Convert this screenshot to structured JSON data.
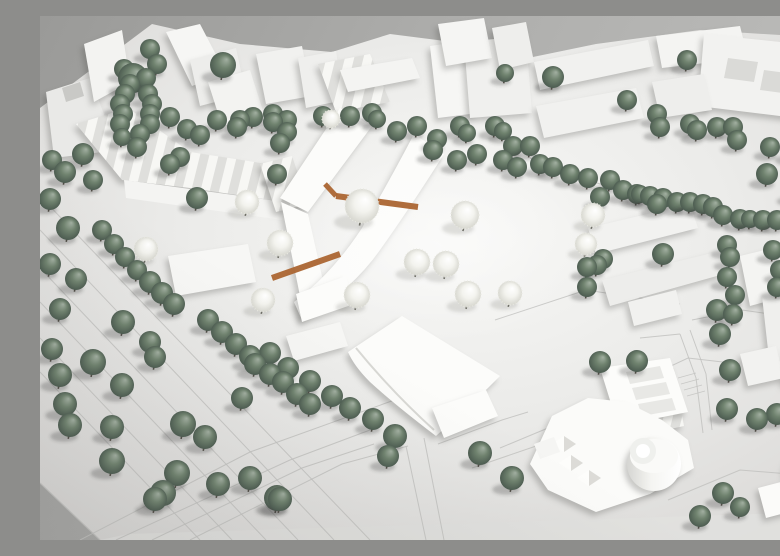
{
  "scene": {
    "description": "Photograph of a white architectural site model: massing buildings, sage-green spherical trees, white blossom trees, engraved street lines, terracotta wooden deck paths, on a gray backdrop"
  },
  "palette": {
    "backdrop_dark": "#9a9a98",
    "backdrop_light": "#bcbcba",
    "base_bright": "#f8f8f6",
    "base_mid": "#ebebe9",
    "base_dim": "#d6d5d3",
    "base_front": "#e1e1df",
    "road_line": "#c2c2bf",
    "building_top": "#f4f4f2",
    "building_new": "#fcfcfa",
    "courtyard": "#dadad7",
    "gable_light": "#f7f7f4",
    "gable_dark": "#dfdfdc",
    "tree_green_hi": "#a3b0a2",
    "tree_green_mid": "#70836f",
    "tree_green_lo": "#47564c",
    "tree_trunk": "#4e4b44",
    "blossom_hi": "#ffffff",
    "blossom_lo": "#d3d3cb",
    "terracotta": "#ab6531",
    "shadow": "rgba(55,60,55,0.28)"
  },
  "base": {
    "outline": "0,92 112,8 200,28 292,36 350,18 476,34 488,42 556,28 660,14 756,20 780,26 780,524 60,524 0,467",
    "front_edge": "60,524 88,518 780,496 780,524",
    "plaza_highlight": [
      390,
      232,
      165,
      100
    ]
  },
  "roads": [
    {
      "p": "0,286 226,524"
    },
    {
      "p": "0,252 258,524"
    },
    {
      "p": "0,214 294,524"
    },
    {
      "p": "0,180 330,524"
    },
    {
      "p": "0,322 192,524"
    },
    {
      "p": "0,356 160,524"
    },
    {
      "p": "40,524 210,436 360,382"
    },
    {
      "p": "76,524 250,444 330,414"
    },
    {
      "p": "112,524 262,452 334,428"
    },
    {
      "p": "150,524 302,448 368,430"
    },
    {
      "p": "398,428 462,404 488,396"
    },
    {
      "p": "432,452 502,428"
    },
    {
      "p": "366,430 386,524"
    },
    {
      "p": "384,422 404,524"
    },
    {
      "p": "640,318 656,362 663,417"
    },
    {
      "p": "650,314 666,358 672,414"
    },
    {
      "p": "600,322 640,318"
    },
    {
      "p": "455,304 546,274 640,288"
    },
    {
      "p": "584,372 648,342 700,348"
    },
    {
      "p": "652,304 702,294 758,302"
    },
    {
      "p": "628,484 700,454 762,459"
    },
    {
      "p": "460,432 532,402"
    },
    {
      "p": "490,142 560,168 670,192"
    },
    {
      "p": "638,362 656,357",
      "w": 0.8
    },
    {
      "p": "641,368 659,363",
      "w": 0.8
    },
    {
      "p": "644,374 662,369",
      "w": 0.8
    },
    {
      "p": "647,380 665,375",
      "w": 0.8
    },
    {
      "p": "0,467 60,524",
      "w": 1.3
    }
  ],
  "buildings": [
    {
      "n": "house-nw",
      "poly": "6,76 50,62 64,98 62,136 14,142",
      "f": "#e9e9e7"
    },
    {
      "n": "house-nw-notch",
      "poly": "22,72 40,66 44,80 26,86",
      "f": "#c9c9c6",
      "flat": 1
    },
    {
      "n": "tower-nw",
      "poly": "44,28 82,14 90,66 54,86",
      "f": "#f3f3f1"
    },
    {
      "n": "slab-n1",
      "poly": "126,16 160,8 186,58 152,70",
      "f": "#f6f6f4"
    },
    {
      "n": "slab-n2",
      "poly": "150,44 196,32 206,78 160,90",
      "f": "#ededeb"
    },
    {
      "n": "sawtooth-row",
      "path": "M36,108 L88,92 L150,136 L240,150 L244,186 L150,172 L82,164 Z",
      "f": "gables"
    },
    {
      "n": "sawtooth-face",
      "poly": "84,164 244,186 242,204 86,182",
      "f": "#f4f4f2",
      "flat": 1
    },
    {
      "n": "gable-house-n",
      "poly": "220,148 252,140 268,188 236,196",
      "f": "gables"
    },
    {
      "n": "slab-n3",
      "poly": "168,66 210,54 224,98 182,110",
      "f": "#f3f3f1"
    },
    {
      "n": "block-n1",
      "poly": "216,38 262,30 272,80 226,88",
      "f": "#f1f1ef"
    },
    {
      "n": "block-n2",
      "poly": "258,42 296,35 304,84 266,92",
      "f": "#efefed"
    },
    {
      "n": "houses-nc",
      "poly": "278,48 330,38 350,86 296,96",
      "f": "gables"
    },
    {
      "n": "bar-nc",
      "poly": "300,54 372,42 380,62 308,76",
      "f": "#f4f4f2"
    },
    {
      "n": "gable-block-nc",
      "poly": "390,30 430,24 438,97 398,102",
      "f": "#f6f6f4"
    },
    {
      "n": "block-nc",
      "poly": "424,26 486,20 492,97 430,102",
      "f": "#f0f0ee"
    },
    {
      "n": "tower-nc1",
      "poly": "398,8 444,2 452,42 406,50",
      "f": "#f5f5f3"
    },
    {
      "n": "tower-nc2",
      "poly": "452,12 486,6 494,46 460,54",
      "f": "#eeeeec"
    },
    {
      "n": "bar-ne",
      "poly": "494,46 608,24 614,50 500,74",
      "f": "#f1f1ef"
    },
    {
      "n": "bar-ne2",
      "poly": "616,20 700,10 708,42 622,52",
      "f": "#f4f4f2"
    },
    {
      "n": "perimeter-block-ne",
      "poly": "664,18 778,30 772,104 658,90",
      "f": "#f2f2f0"
    },
    {
      "n": "courtyard-1",
      "poly": "688,42 718,46 714,66 684,62",
      "f": "#dadad7",
      "flat": 1
    },
    {
      "n": "courtyard-2",
      "poly": "724,54 754,58 750,78 720,74",
      "f": "#dadad7",
      "flat": 1
    },
    {
      "n": "slab-ne3",
      "poly": "496,90 596,72 604,102 504,122",
      "f": "#f1f1ef"
    },
    {
      "n": "block-ne4",
      "poly": "612,66 664,58 672,94 620,102",
      "f": "#eeeeec"
    },
    {
      "n": "slab-e1",
      "poly": "756,122 780,116 780,162 762,167",
      "f": "#f0f0ee"
    },
    {
      "n": "slab-e2",
      "poly": "548,212 650,188 658,212 556,238",
      "f": "#f2f2f0"
    },
    {
      "n": "slab-e3",
      "poly": "562,264 676,236 684,258 570,290",
      "f": "#ededeb"
    },
    {
      "n": "block-e1",
      "poly": "700,240 766,224 776,272 710,290",
      "f": "#f4f4f2"
    },
    {
      "n": "tower-e",
      "poly": "722,280 770,270 778,340 730,352",
      "f": "#efefed"
    },
    {
      "n": "cube-e",
      "poly": "740,344 762,339 766,364 744,369",
      "f": "#f3f3f1"
    },
    {
      "n": "slab-e4",
      "poly": "588,286 636,274 642,298 594,310",
      "f": "#f1f1ef"
    },
    {
      "n": "houses-se",
      "poly": "588,362 634,352 644,410 598,420",
      "f": "gables"
    },
    {
      "n": "kita-block",
      "poly": "128,240 208,228 216,266 136,280",
      "f": "#f7f7f5"
    },
    {
      "n": "chevron-north-wing",
      "poly": "240,182 300,92 332,110 268,196",
      "f": "#fcfcfa"
    },
    {
      "n": "chevron-south-wing",
      "poly": "241,186 268,198 286,278 262,290",
      "f": "#fcfcfa"
    },
    {
      "n": "curved-bar",
      "path": "M374,118 L404,138 Q370,192 340,234 Q312,274 262,304 L254,286 Q292,258 322,212 Q350,164 374,118 Z",
      "f": "#fcfcfa"
    },
    {
      "n": "bar-end-block",
      "poly": "256,278 306,260 314,288 262,306",
      "f": "#fcfcfa"
    },
    {
      "n": "hall-west-bar",
      "poly": "246,320 300,306 308,330 254,345",
      "f": "#f6f6f4"
    },
    {
      "n": "hall",
      "path": "M308,336 L362,300 L460,360 L448,372 L396,420 Q354,388 330,366 Q314,350 308,336 Z",
      "f": "#fcfcfa"
    },
    {
      "n": "hall-facade-curve",
      "path": "M316,332 Q352,376 394,414",
      "f": "none",
      "s": "#d8d8d4",
      "w": 2,
      "flat": 1
    },
    {
      "n": "hall-annex",
      "poly": "392,392 446,374 458,400 404,422",
      "f": "#fcfcfa"
    },
    {
      "n": "cluster-slab",
      "poly": "560,352 630,342 648,396 578,410",
      "f": "#fcfcfa"
    },
    {
      "n": "roof-bar-1",
      "poly": "586,356 620,350 624,362 590,368",
      "f": "#e8e8e5",
      "flat": 1
    },
    {
      "n": "roof-bar-2",
      "poly": "592,372 626,366 630,378 596,384",
      "f": "#e8e8e5",
      "flat": 1
    },
    {
      "n": "roof-bar-3",
      "poly": "598,388 632,382 636,394 602,400",
      "f": "#e8e8e5",
      "flat": 1
    },
    {
      "n": "cluster-main",
      "poly": "490,448 512,400 548,382 586,386 622,404 648,424 654,452 610,478 556,496 508,474",
      "f": "#fbfbf9"
    },
    {
      "n": "cylinder-big",
      "c": [
        614,
        448,
        27
      ],
      "f": "gCyl"
    },
    {
      "n": "cylinder-big-top",
      "e": [
        614,
        440,
        24,
        17
      ],
      "f": "#fafaf8",
      "flat": 1
    },
    {
      "n": "cylinder-ring",
      "c": [
        603,
        435,
        13
      ],
      "f": "#eff0ed",
      "flat": 1
    },
    {
      "n": "cylinder-ring-top",
      "c": [
        603,
        435,
        7
      ],
      "f": "#ffffff",
      "flat": 1
    },
    {
      "n": "pyramid-1-light",
      "poly": "519,447 531,439 531,455",
      "f": "#fdfdfb",
      "flat": 1
    },
    {
      "n": "pyramid-1-dark",
      "poly": "531,439 543,447 531,455",
      "f": "#dcdbd7",
      "flat": 1
    },
    {
      "n": "pyramid-2-light",
      "poly": "537,462 549,454 549,470",
      "f": "#fdfdfb",
      "flat": 1
    },
    {
      "n": "pyramid-2-dark",
      "poly": "549,454 561,462 549,470",
      "f": "#dcdbd7",
      "flat": 1
    },
    {
      "n": "pyramid-3-light",
      "poly": "512,428 524,420 524,436",
      "f": "#fdfdfb",
      "flat": 1
    },
    {
      "n": "pyramid-3-dark",
      "poly": "524,420 536,428 524,436",
      "f": "#dcdbd7",
      "flat": 1
    },
    {
      "n": "steps-block",
      "poly": "494,428 514,421 520,436 500,443",
      "f": "#f5f5f3",
      "flat": 1
    },
    {
      "n": "block-se1",
      "poly": "700,338 736,330 744,362 708,370",
      "f": "#f2f2f0"
    },
    {
      "n": "block-se2",
      "poly": "746,332 780,324 780,370 752,374",
      "f": "#efefed"
    },
    {
      "n": "block-se3",
      "poly": "752,382 780,376 780,428 758,432",
      "f": "#f1f1ef"
    },
    {
      "n": "tower-se-box",
      "poly": "718,472 756,462 764,492 726,502",
      "f": "#fbfbf9"
    },
    {
      "n": "tower-se-cylinder",
      "c": [
        764,
        454,
        19
      ],
      "f": "gCyl"
    },
    {
      "n": "tower-se-cylinder-top",
      "e": [
        763,
        447,
        16,
        11
      ],
      "f": "#f7f7f5",
      "flat": 1
    }
  ],
  "terracotta_paths": [
    {
      "p": "285,168 296,180",
      "w": 5
    },
    {
      "p": "296,180 378,191",
      "w": 6
    },
    {
      "p": "232,262 300,238",
      "w": 6
    }
  ],
  "trees_green": [
    [
      93,
      62,
      15
    ],
    [
      183,
      49,
      13
    ],
    [
      110,
      33,
      10
    ],
    [
      117,
      48,
      10
    ],
    [
      106,
      62,
      10
    ],
    [
      84,
      53,
      10
    ],
    [
      90,
      68,
      10
    ],
    [
      85,
      78,
      10
    ],
    [
      80,
      88,
      10
    ],
    [
      108,
      78,
      10
    ],
    [
      112,
      88,
      10
    ],
    [
      83,
      98,
      10
    ],
    [
      110,
      98,
      10
    ],
    [
      80,
      108,
      10
    ],
    [
      110,
      108,
      10
    ],
    [
      100,
      118,
      10
    ],
    [
      82,
      121,
      9
    ],
    [
      97,
      131,
      10
    ],
    [
      130,
      101,
      10
    ],
    [
      147,
      113,
      10
    ],
    [
      160,
      119,
      10
    ],
    [
      177,
      104,
      10
    ],
    [
      197,
      111,
      10
    ],
    [
      213,
      101,
      10
    ],
    [
      233,
      98,
      10
    ],
    [
      247,
      104,
      10
    ],
    [
      140,
      141,
      10
    ],
    [
      130,
      148,
      10
    ],
    [
      157,
      182,
      11
    ],
    [
      237,
      158,
      10
    ],
    [
      240,
      127,
      10
    ],
    [
      43,
      138,
      11
    ],
    [
      25,
      156,
      11
    ],
    [
      53,
      164,
      10
    ],
    [
      12,
      144,
      10
    ],
    [
      10,
      183,
      11
    ],
    [
      28,
      212,
      12
    ],
    [
      10,
      248,
      11
    ],
    [
      36,
      263,
      11
    ],
    [
      20,
      293,
      11
    ],
    [
      62,
      214,
      10
    ],
    [
      74,
      228,
      10
    ],
    [
      85,
      241,
      10
    ],
    [
      97,
      254,
      10
    ],
    [
      110,
      266,
      11
    ],
    [
      122,
      277,
      11
    ],
    [
      134,
      288,
      11
    ],
    [
      200,
      104,
      10
    ],
    [
      233,
      106,
      10
    ],
    [
      247,
      116,
      10
    ],
    [
      283,
      100,
      10
    ],
    [
      310,
      100,
      10
    ],
    [
      332,
      97,
      10
    ],
    [
      337,
      103,
      9
    ],
    [
      357,
      115,
      10
    ],
    [
      377,
      110,
      10
    ],
    [
      397,
      123,
      10
    ],
    [
      420,
      110,
      10
    ],
    [
      427,
      117,
      9
    ],
    [
      455,
      110,
      10
    ],
    [
      463,
      115,
      9
    ],
    [
      473,
      130,
      10
    ],
    [
      490,
      130,
      10
    ],
    [
      465,
      57,
      9
    ],
    [
      393,
      134,
      10
    ],
    [
      417,
      144,
      10
    ],
    [
      437,
      138,
      10
    ],
    [
      463,
      144,
      10
    ],
    [
      477,
      151,
      10
    ],
    [
      513,
      61,
      11
    ],
    [
      587,
      84,
      10
    ],
    [
      617,
      98,
      10
    ],
    [
      620,
      111,
      10
    ],
    [
      647,
      44,
      10
    ],
    [
      650,
      108,
      10
    ],
    [
      657,
      114,
      10
    ],
    [
      677,
      111,
      10
    ],
    [
      693,
      111,
      10
    ],
    [
      697,
      124,
      10
    ],
    [
      730,
      131,
      10
    ],
    [
      753,
      134,
      11
    ],
    [
      727,
      158,
      11
    ],
    [
      763,
      161,
      11
    ],
    [
      500,
      148,
      10
    ],
    [
      513,
      151,
      10
    ],
    [
      530,
      158,
      10
    ],
    [
      548,
      162,
      10
    ],
    [
      570,
      164,
      10
    ],
    [
      583,
      174,
      10
    ],
    [
      597,
      178,
      10
    ],
    [
      610,
      180,
      10
    ],
    [
      623,
      182,
      10
    ],
    [
      637,
      186,
      10
    ],
    [
      650,
      186,
      10
    ],
    [
      663,
      188,
      10
    ],
    [
      560,
      181,
      10
    ],
    [
      600,
      178,
      9
    ],
    [
      617,
      188,
      10
    ],
    [
      673,
      191,
      10
    ],
    [
      683,
      199,
      10
    ],
    [
      700,
      203,
      10
    ],
    [
      710,
      203,
      9
    ],
    [
      723,
      204,
      10
    ],
    [
      737,
      204,
      10
    ],
    [
      753,
      176,
      10
    ],
    [
      770,
      184,
      10
    ],
    [
      623,
      238,
      11
    ],
    [
      687,
      229,
      10
    ],
    [
      690,
      241,
      10
    ],
    [
      687,
      261,
      10
    ],
    [
      733,
      234,
      10
    ],
    [
      740,
      254,
      10
    ],
    [
      747,
      268,
      10
    ],
    [
      757,
      248,
      10
    ],
    [
      737,
      271,
      10
    ],
    [
      677,
      294,
      11
    ],
    [
      695,
      279,
      10
    ],
    [
      680,
      318,
      11
    ],
    [
      693,
      298,
      10
    ],
    [
      547,
      251,
      10
    ],
    [
      557,
      249,
      10
    ],
    [
      547,
      271,
      10
    ],
    [
      563,
      243,
      10
    ],
    [
      560,
      346,
      11
    ],
    [
      597,
      345,
      11
    ],
    [
      690,
      354,
      11
    ],
    [
      687,
      393,
      11
    ],
    [
      717,
      403,
      11
    ],
    [
      737,
      398,
      11
    ],
    [
      767,
      460,
      11
    ],
    [
      775,
      480,
      10
    ],
    [
      778,
      494,
      10
    ],
    [
      683,
      477,
      11
    ],
    [
      660,
      500,
      11
    ],
    [
      700,
      491,
      10
    ],
    [
      168,
      304,
      11
    ],
    [
      182,
      316,
      11
    ],
    [
      196,
      328,
      11
    ],
    [
      210,
      340,
      11
    ],
    [
      230,
      337,
      11
    ],
    [
      248,
      352,
      11
    ],
    [
      270,
      365,
      11
    ],
    [
      292,
      380,
      11
    ],
    [
      310,
      392,
      11
    ],
    [
      333,
      403,
      11
    ],
    [
      355,
      420,
      12
    ],
    [
      215,
      348,
      11
    ],
    [
      230,
      358,
      11
    ],
    [
      243,
      366,
      11
    ],
    [
      257,
      378,
      11
    ],
    [
      270,
      388,
      11
    ],
    [
      202,
      382,
      11
    ],
    [
      440,
      437,
      12
    ],
    [
      472,
      462,
      12
    ],
    [
      12,
      333,
      11
    ],
    [
      20,
      359,
      12
    ],
    [
      25,
      388,
      12
    ],
    [
      30,
      409,
      12
    ],
    [
      53,
      346,
      13
    ],
    [
      83,
      306,
      12
    ],
    [
      82,
      369,
      12
    ],
    [
      72,
      411,
      12
    ],
    [
      110,
      326,
      11
    ],
    [
      115,
      341,
      11
    ],
    [
      143,
      408,
      13
    ],
    [
      165,
      421,
      12
    ],
    [
      72,
      445,
      13
    ],
    [
      137,
      457,
      13
    ],
    [
      123,
      477,
      13
    ],
    [
      178,
      468,
      12
    ],
    [
      210,
      462,
      12
    ],
    [
      237,
      482,
      13
    ],
    [
      348,
      440,
      11
    ],
    [
      115,
      483,
      12
    ],
    [
      240,
      483,
      12
    ]
  ],
  "trees_blossom": [
    [
      322,
      190,
      17
    ],
    [
      425,
      199,
      14
    ],
    [
      377,
      246,
      13
    ],
    [
      406,
      248,
      13
    ],
    [
      317,
      279,
      13
    ],
    [
      428,
      278,
      13
    ],
    [
      470,
      277,
      12
    ],
    [
      240,
      227,
      13
    ],
    [
      223,
      284,
      12
    ],
    [
      207,
      186,
      12
    ],
    [
      106,
      233,
      12
    ],
    [
      553,
      199,
      12
    ],
    [
      546,
      228,
      11
    ],
    [
      291,
      103,
      9
    ]
  ]
}
